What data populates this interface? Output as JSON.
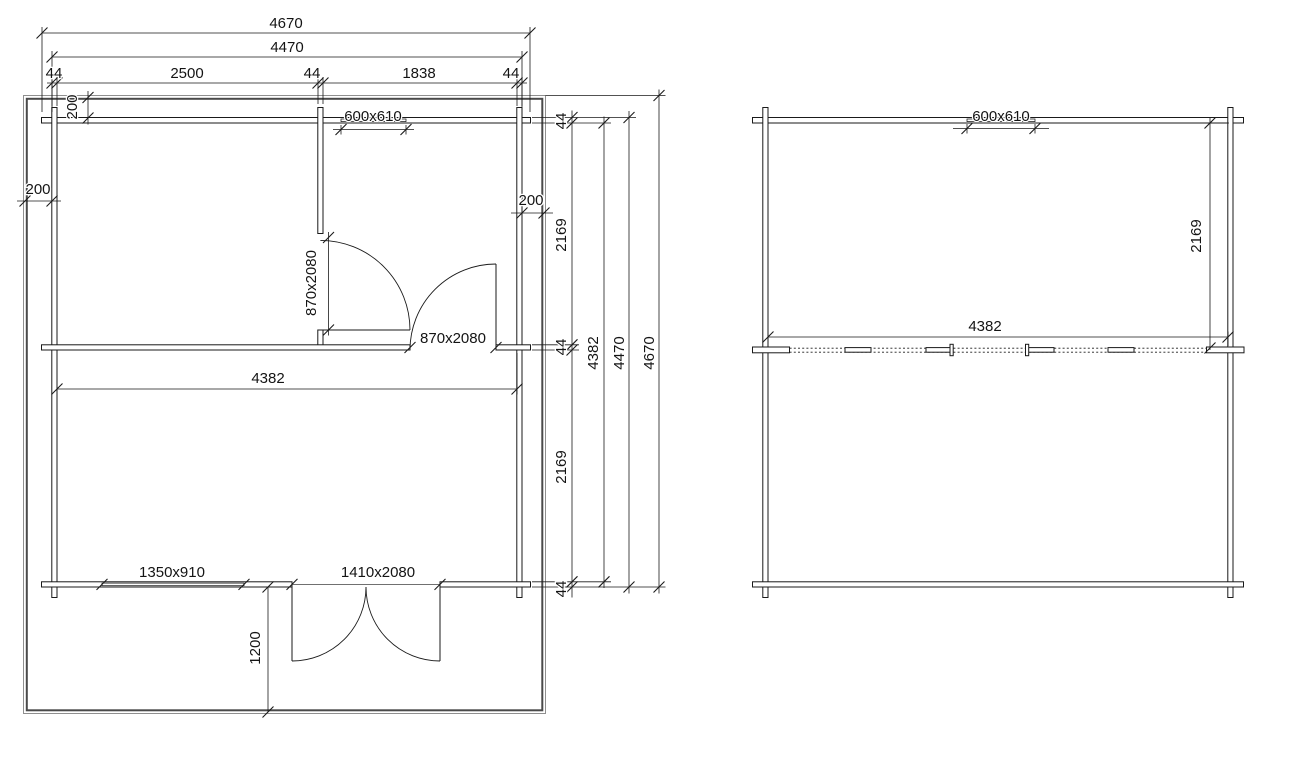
{
  "sheet": {
    "background": "#ffffff",
    "line_color": "#1a1a1a"
  },
  "ground_floor_plan": {
    "dims": {
      "overall_width": "4670",
      "shell_width": "4470",
      "width_chain": [
        "44",
        "2500",
        "44",
        "1838",
        "44"
      ],
      "top_window": "600x610",
      "roof_overhang_top": "200",
      "roof_overhang_left": "200",
      "roof_overhang_right": "200",
      "partition_door": "870x2080",
      "middle_door": "870x2080",
      "clear_width": "4382",
      "height_chain": [
        "44",
        "2169",
        "44",
        "2169",
        "44"
      ],
      "clear_height": "4382",
      "shell_height": "4470",
      "overall_height": "4670",
      "bottom_window": "1350x910",
      "entrance_door": "1410x2080",
      "terrace_depth": "1200"
    }
  },
  "loft_plan": {
    "dims": {
      "top_window": "600x610",
      "room_depth": "2169",
      "clear_width": "4382"
    }
  }
}
